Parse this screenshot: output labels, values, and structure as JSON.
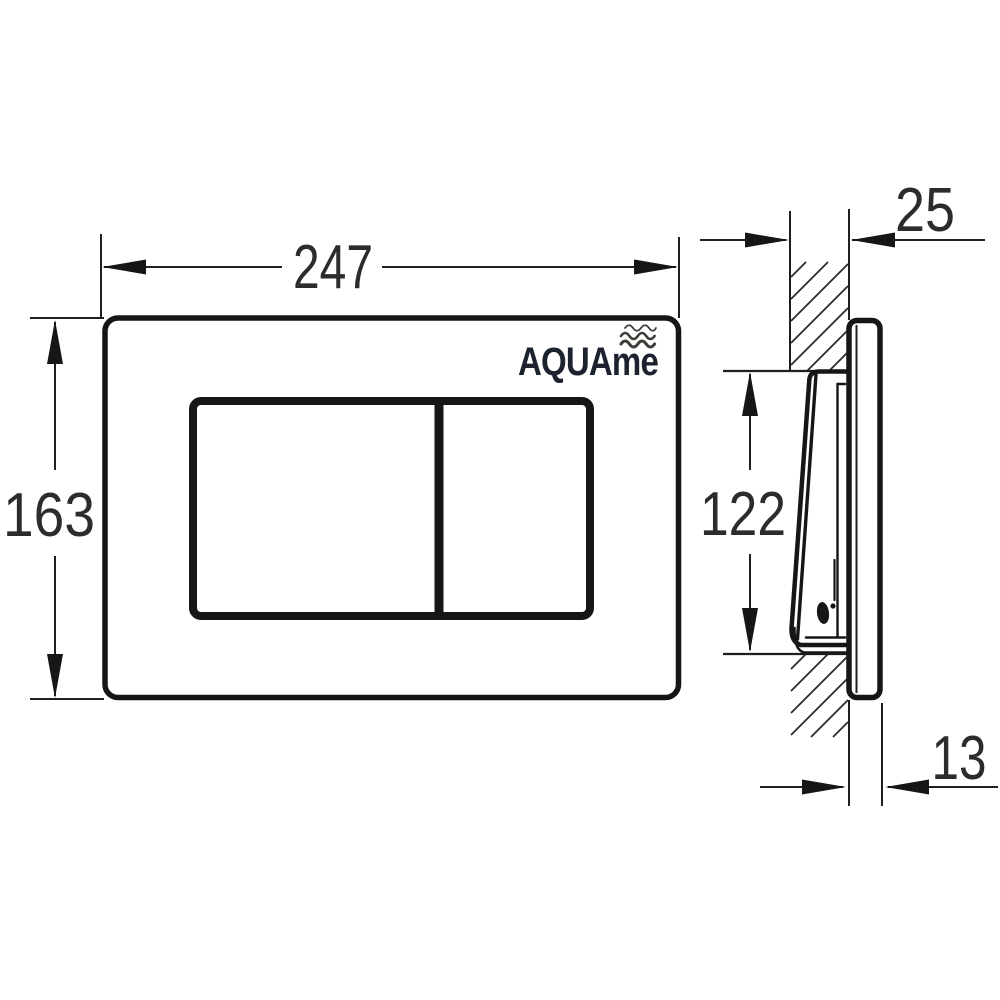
{
  "drawing": {
    "brand": {
      "name": "AQUAme",
      "icon": "waves-icon",
      "text_color": "#1c222e",
      "waves_color": "#3a4038"
    },
    "front_view": {
      "dim_width": "247",
      "dim_height": "163"
    },
    "side_view": {
      "dim_depth": "25",
      "dim_opening_height": "122",
      "dim_thickness": "13"
    },
    "colors": {
      "background": "#ffffff",
      "lines": "#161616",
      "dimension_text": "#2c2c2c"
    }
  }
}
